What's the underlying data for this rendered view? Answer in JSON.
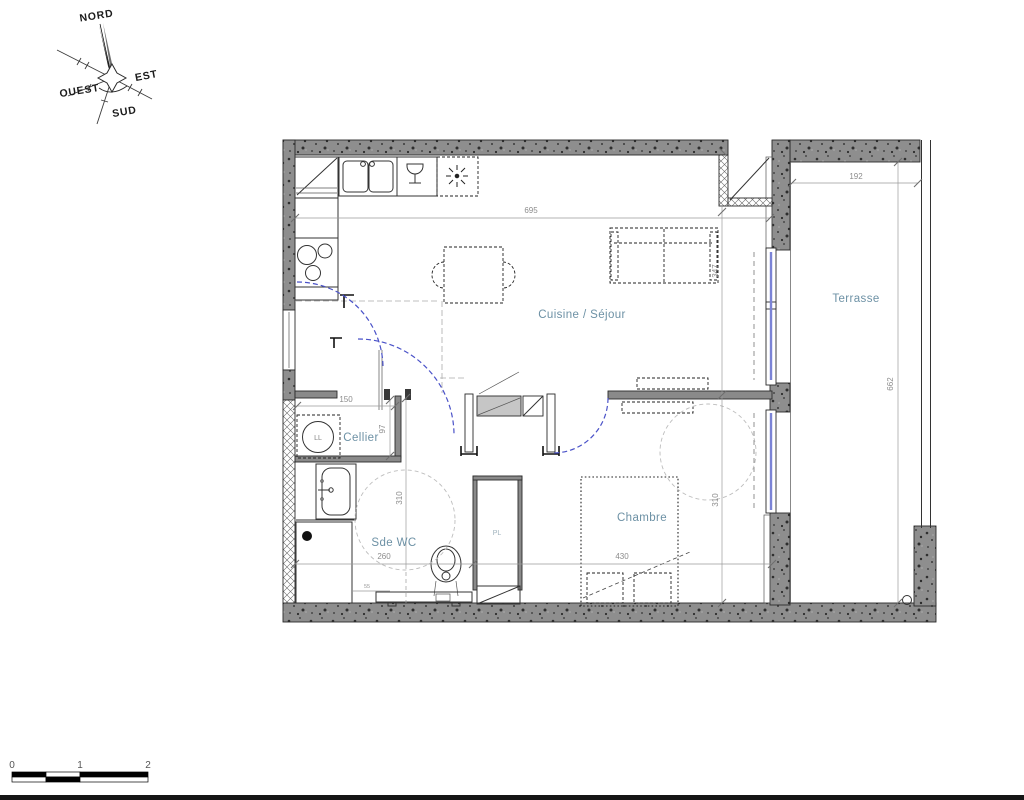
{
  "compass": {
    "north": "NORD",
    "east": "EST",
    "south": "SUD",
    "west": "OUEST"
  },
  "rooms": {
    "living": "Cuisine / Séjour",
    "terrace": "Terrasse",
    "cellar": "Cellier",
    "bedroom": "Chambre",
    "bathroom": "Sde WC",
    "closet": "PL",
    "washer": "LL"
  },
  "dims": {
    "living_w": "695",
    "terrace_w": "192",
    "living_h": "347",
    "terrace_h": "662",
    "cellar_w": "150",
    "cellar_h": "97",
    "bath_h": "310",
    "bath_w": "260",
    "bed_h": "310",
    "bed_w": "430",
    "step": "55"
  },
  "scalebar": {
    "t0": "0",
    "t1": "1",
    "t2": "2"
  },
  "colors": {
    "room_label": "#6d91a5",
    "dim_text": "#8c8c8c",
    "wall_gray": "#8e8e8e",
    "window_blue": "#7b83d6",
    "door_arc": "#4a52c8"
  }
}
